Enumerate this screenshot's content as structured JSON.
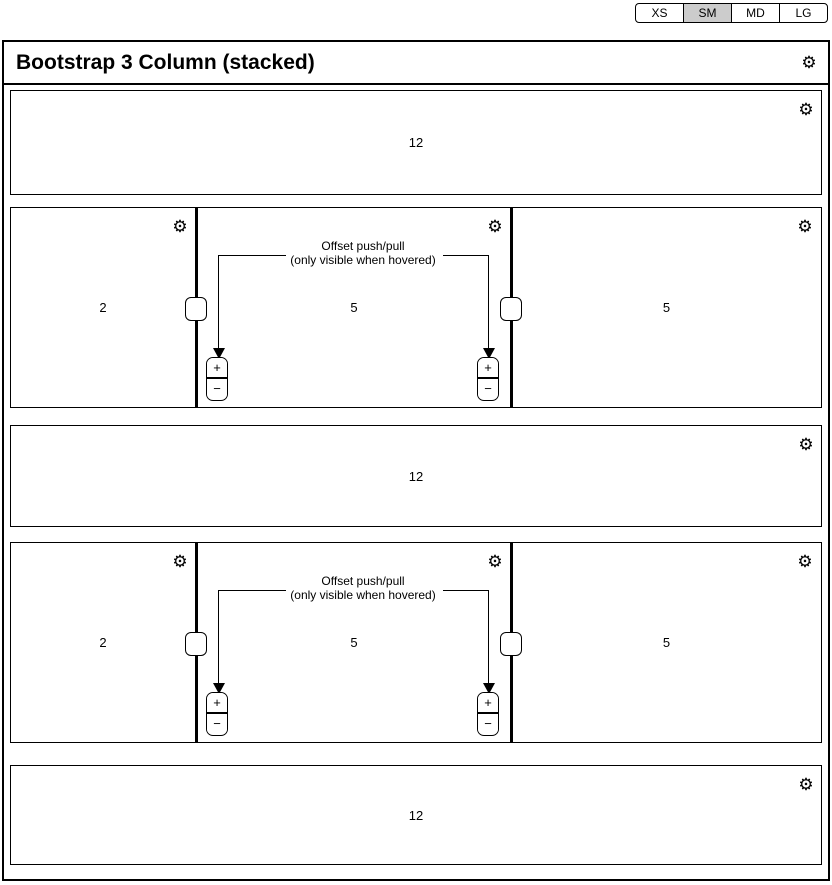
{
  "breakpoint_bar": {
    "tabs": [
      {
        "label": "XS",
        "active": false
      },
      {
        "label": "SM",
        "active": true
      },
      {
        "label": "MD",
        "active": false
      },
      {
        "label": "LG",
        "active": false
      }
    ]
  },
  "header": {
    "title": "Bootstrap 3 Column (stacked)"
  },
  "icons": {
    "gear": "⚙"
  },
  "annotation": {
    "line1": "Offset push/pull",
    "line2": "(only visible when hovered)"
  },
  "stepper": {
    "plus": "+",
    "minus": "−"
  },
  "rows": [
    {
      "kind": "full",
      "label": "12"
    },
    {
      "kind": "split",
      "columns": [
        {
          "label": "2"
        },
        {
          "label": "5"
        },
        {
          "label": "5"
        }
      ]
    },
    {
      "kind": "full",
      "label": "12"
    },
    {
      "kind": "split",
      "columns": [
        {
          "label": "2"
        },
        {
          "label": "5"
        },
        {
          "label": "5"
        }
      ]
    },
    {
      "kind": "full",
      "label": "12"
    }
  ],
  "colors": {
    "border": "#000000",
    "background": "#ffffff",
    "active_tab": "#cccccc"
  }
}
